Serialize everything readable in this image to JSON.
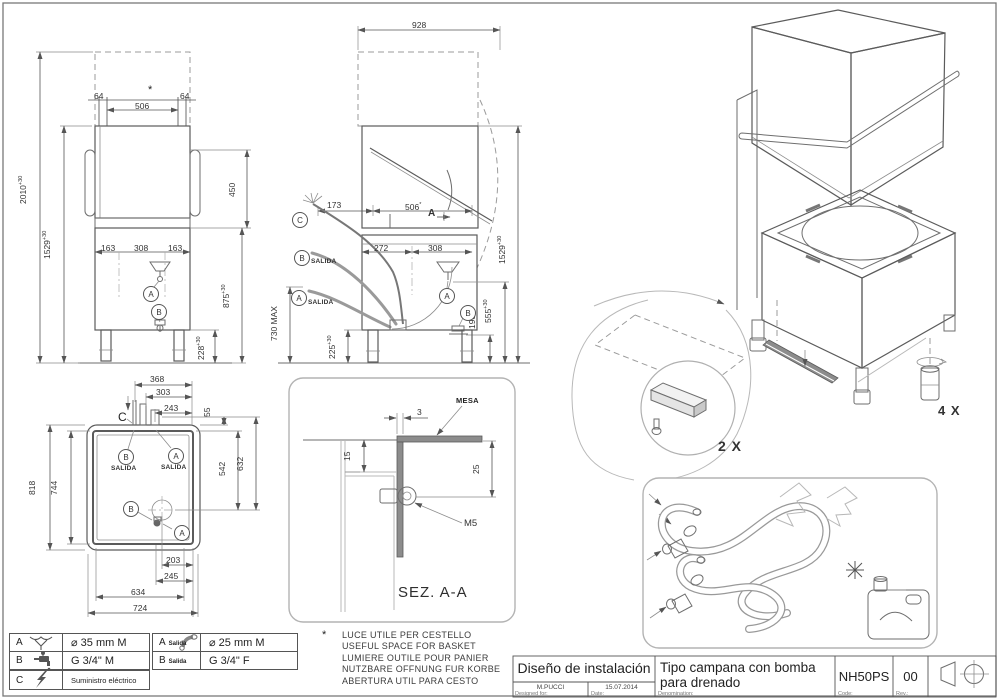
{
  "common": {
    "tolerance": "+30"
  },
  "front_view": {
    "dim_col_left": "64",
    "dim_col_right": "64",
    "dim_opening_width": "506",
    "note_marker": "*",
    "dim_total_height": "2010",
    "dim_machine_height": "1529",
    "dim_hood_stroke": "450",
    "dim_left_offset": "163",
    "dim_center": "308",
    "dim_right_offset": "163",
    "dim_counter_height": "875",
    "dim_leg_height": "228",
    "callout_a": "A",
    "callout_b": "B"
  },
  "side_view": {
    "dim_total_depth": "928",
    "dim_hose_offset": "173",
    "dim_opening_depth": "506",
    "note_marker": "*",
    "section_label": "A",
    "dim_back_offset": "272",
    "dim_drain_offset": "308",
    "callout_c": "C",
    "callout_b": "B",
    "callout_a": "A",
    "salida": "SALIDA",
    "dim_hose_max": "730 MAX",
    "dim_frame_height": "225",
    "dim_tap_height": "198",
    "dim_funnel_height": "555",
    "dim_machine_height": "1529",
    "callout_a2": "A",
    "callout_b2": "B"
  },
  "plan_view": {
    "dim_368": "368",
    "dim_303": "303",
    "dim_243": "243",
    "dim_55": "55",
    "dim_818": "818",
    "dim_744": "744",
    "dim_542": "542",
    "dim_632": "632",
    "dim_203": "203",
    "dim_245": "245",
    "dim_634": "634",
    "dim_724": "724",
    "callout_c": "C",
    "callout_b": "B",
    "callout_a": "A",
    "salida": "SALIDA",
    "callout_b2": "B",
    "callout_a2": "A"
  },
  "section_view": {
    "title": "SEZ. A-A",
    "mesa_label": "MESA",
    "screw_label": "M5",
    "dim_3": "3",
    "dim_15": "15",
    "dim_25": "25"
  },
  "iso_view": {
    "bracket_qty": "2 X",
    "feet_qty": "4 X"
  },
  "note": {
    "marker": "*",
    "lines": [
      "LUCE UTILE PER CESTELLO",
      "USEFUL SPACE FOR BASKET",
      "LUMIERE OUTILE POUR PANIER",
      "NUTZBARE OFFNUNG FUR KORBE",
      "ABERTURA UTIL PARA CESTO"
    ]
  },
  "legend": {
    "drain": {
      "key": "A",
      "value": "⌀ 35 mm M"
    },
    "water": {
      "key": "B",
      "value": "G 3/4\" M"
    },
    "electric": {
      "key": "C",
      "value": "Suministro eléctrico"
    },
    "drain_out": {
      "key": "A",
      "sub": "Salida",
      "value": "⌀ 25 mm M"
    },
    "water_out": {
      "key": "B",
      "sub": "Salida",
      "value": "G 3/4\" F"
    }
  },
  "title_block": {
    "title": "Diseño de instalación",
    "designer_label": "Designed for:",
    "designer": "M.PUCCI",
    "date_label": "Date:",
    "date": "15.07.2014",
    "denomination_label": "Denomination:",
    "denomination_line1": "Tipo campana con bomba",
    "denomination_line2": "para drenado",
    "code_label": "Code:",
    "code": "NH50PS",
    "rev_label": "Rev.:",
    "rev": "00"
  }
}
